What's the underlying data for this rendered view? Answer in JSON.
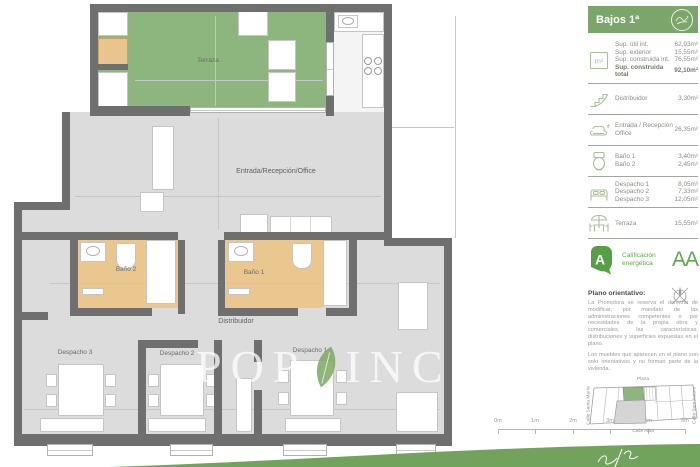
{
  "header": {
    "title": "Bajos 1ª"
  },
  "sidebar": {
    "summary": {
      "rows": [
        {
          "label": "Sup. útil int.",
          "value": "62,93m²"
        },
        {
          "label": "Sup. exterior",
          "value": "15,55m²"
        },
        {
          "label": "Sup. construida int.",
          "value": "76,55m²"
        },
        {
          "label": "Sup. construida total",
          "value": "92,10m²"
        }
      ]
    },
    "sections": [
      {
        "items": [
          {
            "label": "Distribuidor",
            "value": "3,30m²"
          }
        ]
      },
      {
        "items": [
          {
            "label": "Entrada / Recepción",
            "label2": "Office",
            "value": "26,35m²"
          }
        ]
      },
      {
        "items": [
          {
            "label": "Baño 1",
            "value": "3,40m²"
          },
          {
            "label": "Baño 2",
            "value": "2,45m²"
          }
        ]
      },
      {
        "items": [
          {
            "label": "Despacho 1",
            "value": "8,05m²"
          },
          {
            "label": "Despacho 2",
            "value": "7,33m²"
          },
          {
            "label": "Despacho 3",
            "value": "12,05m²"
          }
        ]
      },
      {
        "items": [
          {
            "label": "Terraza",
            "value": "15,55m²"
          }
        ]
      }
    ],
    "energy": {
      "line1": "Calificación",
      "line2": "energética",
      "rating": "AA"
    },
    "disclaimer": {
      "heading": "Plano orientativo:",
      "p1": "La Promotora se reserva el derecho de modificar, por mandato de las administraciones competentes o por necesidades de la propia obra y comerciales, las características, distribuciones y superficies expuestas en el plano.",
      "p2": "Los muebles que aparecen en el plano son solo orientativos y no forman parte de la vivienda."
    },
    "map": {
      "top": "Plaza",
      "left": "Calle Santa María",
      "right": "Calle Sant Antoni",
      "bottom": "Calle Alba"
    }
  },
  "plan": {
    "labels": {
      "terraza": "Terraza",
      "entrada": "Entrada/Recepción/Office",
      "bano2": "Baño 2",
      "bano1": "Baño 1",
      "distribuidor": "Distribuidor",
      "despacho3": "Despacho 3",
      "despacho2": "Despacho 2",
      "despacho1": "Despacho 1"
    }
  },
  "icons": {
    "m2": "m²"
  },
  "watermark": {
    "left": "POP",
    "right": "INCA"
  },
  "scalebar": {
    "labels": [
      "0m",
      "1m",
      "2m",
      "3m",
      "4m",
      "5m"
    ]
  },
  "colors": {
    "accent_green": "#7ba56a",
    "terrace_green": "#8db67e",
    "energy_green": "#62a651",
    "wall_gray": "#6f6f6f",
    "floor_gray": "#dcdcdd",
    "bath_tan": "#e9c78f"
  }
}
